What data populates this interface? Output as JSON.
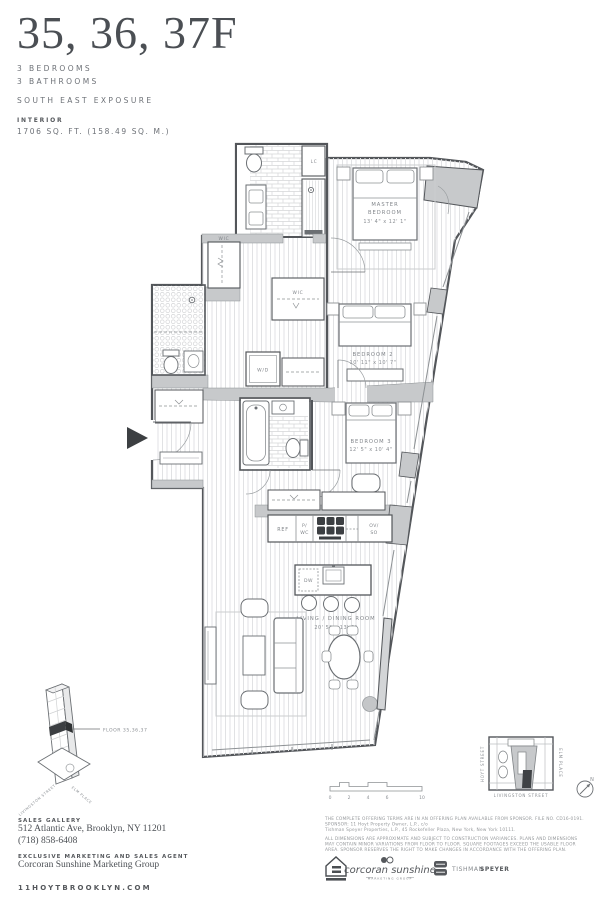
{
  "header": {
    "title": "35, 36, 37F",
    "spec1": "3 BEDROOMS",
    "spec2": "3 BATHROOMS",
    "exposure": "SOUTH EAST EXPOSURE",
    "interior_label": "INTERIOR",
    "interior_area": "1706 SQ. FT. (158.49 SQ. M.)"
  },
  "plan": {
    "rooms": {
      "master": {
        "line1": "MASTER",
        "line2": "BEDROOM",
        "dims": "13' 4\" x 12' 1\""
      },
      "bedroom2": {
        "name": "BEDROOM 2",
        "dims": "10' 11\" x 10' 7\""
      },
      "bedroom3": {
        "name": "BEDROOM 3",
        "dims": "12' 5\" x 10' 4\""
      },
      "living": {
        "name": "LIVING / DINING ROOM",
        "dims": "20' 5\" x 13' 9\""
      }
    },
    "fixtures": {
      "wic_left": "WIC",
      "wic_right": "WIC",
      "wd": "W/D",
      "lc": "LC",
      "dw": "DW",
      "ref": "REF",
      "pwc_line1": "P/",
      "pwc_line2": "WC",
      "ovso_line1": "OV/",
      "ovso_line2": "SO"
    },
    "scale_ticks": [
      "0",
      "2",
      "4",
      "6",
      "10"
    ]
  },
  "building": {
    "floor_label": "FLOOR 35,36,37",
    "street_left": "LIVINGSTON STREET",
    "street_right": "ELM PLACE"
  },
  "map": {
    "street_left": "HOYT STREET",
    "street_right": "ELM PLACE",
    "street_bottom": "LIVINGSTON STREET",
    "compass": "N"
  },
  "footer": {
    "sales_gallery_label": "SALES GALLERY",
    "address": "512 Atlantic Ave, Brooklyn, NY 11201",
    "phone": "(718) 858-6408",
    "agent_label": "EXCLUSIVE MARKETING AND SALES AGENT",
    "agent_name": "Corcoran Sunshine Marketing Group",
    "website": "11HOYTBROOKLYN.COM",
    "legal1_lines": [
      "THE COMPLETE OFFERING TERMS ARE IN AN OFFERING PLAN AVAILABLE FROM SPONSOR. FILE NO. CD16-0191.",
      "SPONSOR: 11 Hoyt Property Owner, L.P., c/o",
      "Tishman Speyer Properties, L.P., 45 Rockefeller Plaza, New York, New York 10111."
    ],
    "legal2_lines": [
      "ALL DIMENSIONS ARE APPROXIMATE AND SUBJECT TO CONSTRUCTION VARIANCES. PLANS AND DIMENSIONS",
      "MAY CONTAIN MINOR VARIATIONS FROM FLOOR TO FLOOR. SQUARE FOOTAGES EXCEED THE USABLE FLOOR",
      "AREA. SPONSOR RESERVES THE RIGHT TO MAKE CHANGES IN ACCORDANCE WITH THE OFFERING PLAN."
    ],
    "logo_corcoran_script": "corcoran sunshine",
    "logo_corcoran_sub": "MARKETING GROUP",
    "logo_tishman_word1": "TISHMAN",
    "logo_tishman_word2": "SPEYER"
  },
  "colors": {
    "ink": "#55585c",
    "wall_gray": "#c7c9cb",
    "accent_dark": "#3c3f42"
  }
}
